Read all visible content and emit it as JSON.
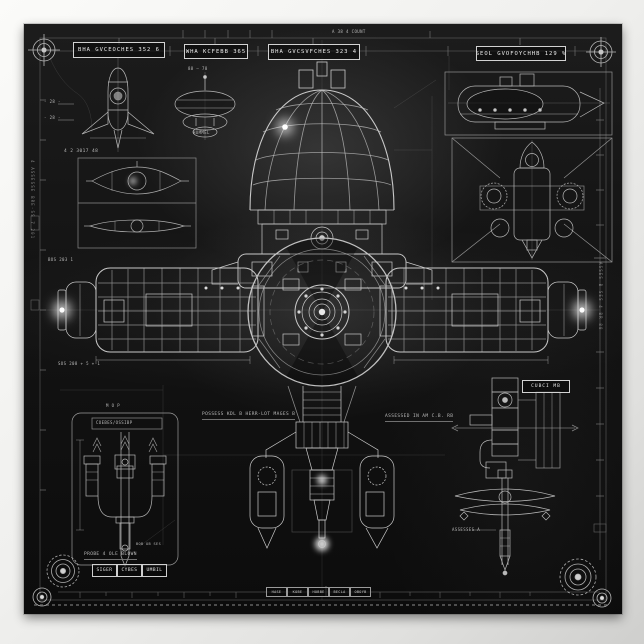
{
  "poster": {
    "colors": {
      "paper": "#f1f1ef",
      "ink": "#d6d6d6",
      "background": "#141414",
      "glow": "#ffffff"
    },
    "title_boxes": [
      {
        "label": "BHA GVCEOCHES 352 6"
      },
      {
        "label": "WHA KCFEBB 365"
      },
      {
        "label": "BHA GVCSVFCHES 323 4"
      },
      {
        "label": "SEOL GVOFOYCHHB 129 %"
      }
    ],
    "captions": {
      "top_right_note": "A 38 4 COUNT",
      "dim_a": "- 28 -",
      "dim_b": "- 28 -",
      "panel_note": "4 2 3017 48",
      "panel_sub": "BOS 203 1",
      "left_note": "SOS 208 + 5 + 1",
      "saucer_top": "88 — 78",
      "saucer_bottom": "HUMMEL",
      "center_left_note": "POSSESS KDL B HERR-LOT MAGES B",
      "center_right_note": "ASSESSED IN AM C.B. RB",
      "mech_title": "COEBES/OSSIBP",
      "mech_note": "M O P",
      "mech_extra": "BOB OB SES",
      "mech_caption": "PROBE 4 OLE BLOWN",
      "mech2_caption": "ASSESSES A",
      "mech2_tag": "CUBCI MB",
      "left_edge_text": "4 ASSESSE BRE-SS 7 201",
      "right_edge_text": "ASSES B SES 4 BR 88"
    },
    "footer_cells": [
      "HASE",
      "KOBE",
      "HOBBE",
      "BECLA",
      "OBOYB"
    ],
    "name_cells": [
      "SIGER",
      "CYBES",
      "UMBIL"
    ]
  }
}
